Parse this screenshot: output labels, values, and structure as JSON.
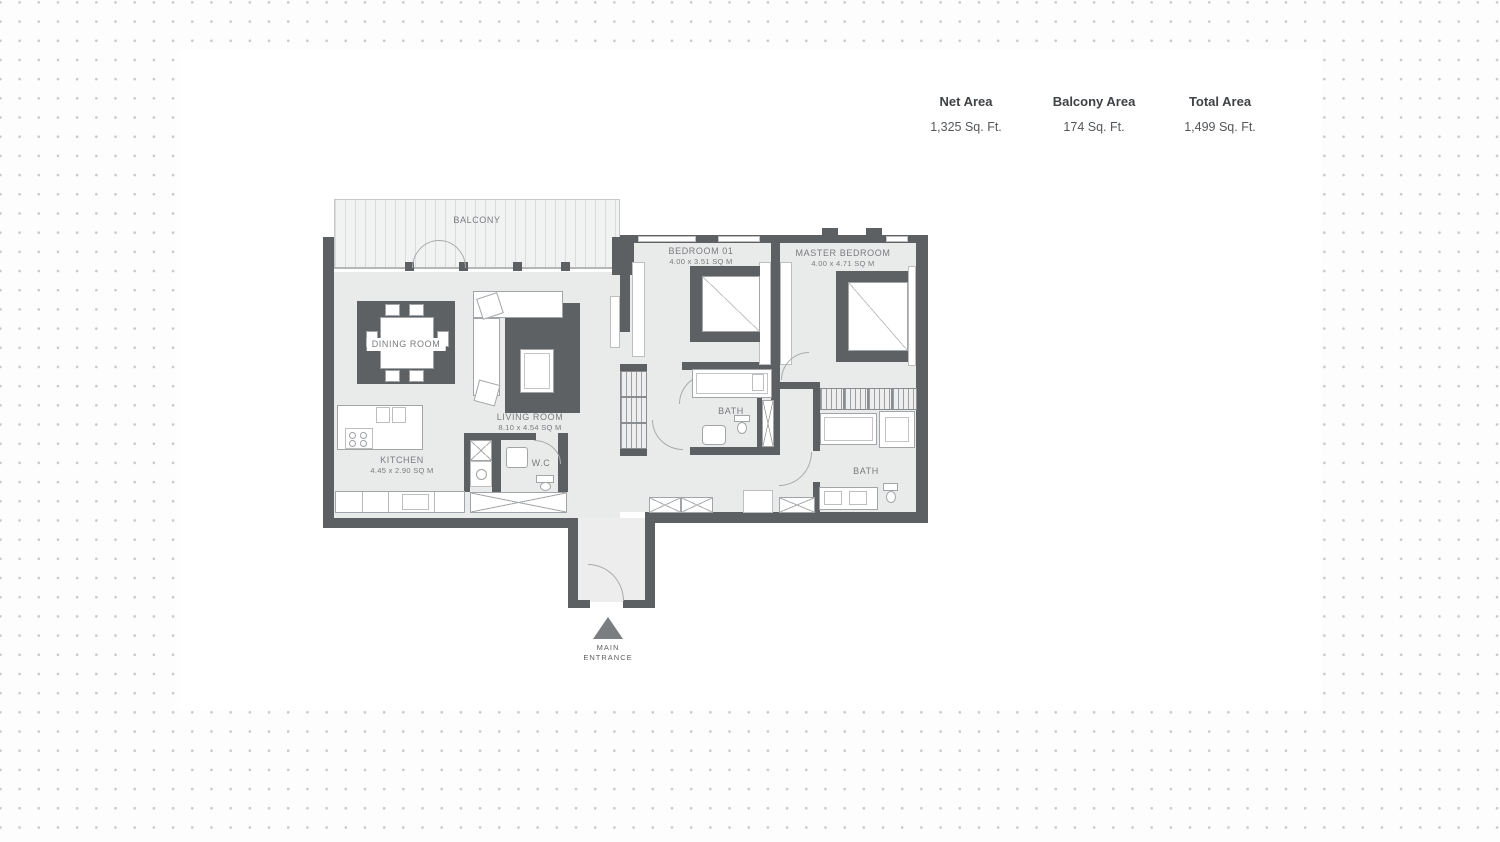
{
  "stats": {
    "columns": [
      {
        "label": "Net Area",
        "value": "1,325 Sq. Ft."
      },
      {
        "label": "Balcony Area",
        "value": "174 Sq. Ft."
      },
      {
        "label": "Total Area",
        "value": "1,499 Sq. Ft."
      }
    ]
  },
  "floorplan": {
    "balcony": {
      "label": "BALCONY"
    },
    "dining": {
      "label": "DINING ROOM"
    },
    "living": {
      "label": "LIVING ROOM",
      "dims": "8.10 x 4.54 SQ M"
    },
    "kitchen": {
      "label": "KITCHEN",
      "dims": "4.45 x 2.90 SQ M"
    },
    "wc": {
      "label": "W.C"
    },
    "bedroom01": {
      "label": "BEDROOM 01",
      "dims": "4.00 x 3.51 SQ M"
    },
    "master": {
      "label": "MASTER BEDROOM",
      "dims": "4.00 x 4.71 SQ M"
    },
    "bath1": {
      "label": "BATH"
    },
    "master_bath": {
      "label": "BATH"
    },
    "entrance": {
      "line1": "MAIN",
      "line2": "ENTRANCE"
    }
  },
  "colors": {
    "wall": "#5d6063",
    "floor": "#e9eaea",
    "rug": "#5e6164",
    "entrance_arrow": "#7b7e81",
    "background_dot": "#c7c9ca"
  }
}
